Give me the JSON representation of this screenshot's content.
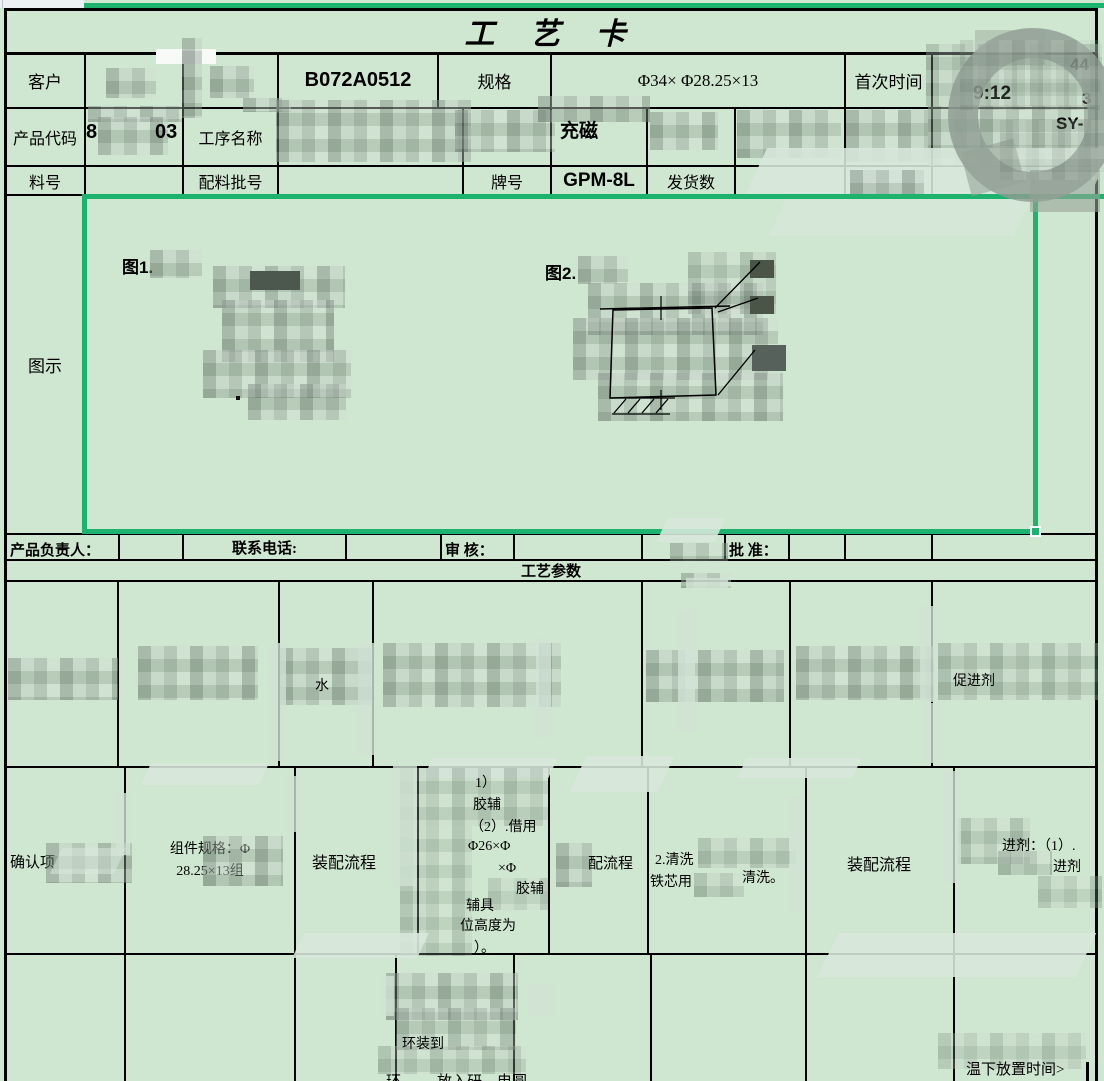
{
  "app": {
    "title_card": "工 艺 卡"
  },
  "header": {
    "customer_label": "客户",
    "order_code": "B072A0512",
    "spec_label": "规格",
    "spec_value": "Φ34× Φ28.25×13",
    "first_time_label": "首次时间",
    "first_time_fragments": {
      "a": "44",
      "b": "9:12",
      "c": "3"
    },
    "product_code_label": "产品代码",
    "product_code_fragments": {
      "left": "8",
      "right": "03"
    },
    "process_name_label": "工序名称",
    "process_fragment": "充磁",
    "right_fragment": "SY-",
    "material_label": "料号",
    "batch_label": "配料批号",
    "grade_label": "牌号",
    "grade_value": "GPM-8L",
    "ship_label": "发货数"
  },
  "diagram": {
    "row_label": "图示",
    "fig1_label": "图1.",
    "fig2_label": "图2."
  },
  "signatures": {
    "owner": "产品负责人：",
    "phone": "联系电话:",
    "review": "审  核：",
    "approve": "批  准："
  },
  "params": {
    "section_title": "工艺参数",
    "row_a": {
      "c3_fragment": "水",
      "c7_fragment": "促进剂"
    },
    "row_b": {
      "confirm_item": "确认项",
      "component_spec_line1": "组件规格：Φ",
      "component_spec_line2": "28.25×13组",
      "assembly_flow_1": "装配流程",
      "detail_lines": [
        "1）",
        "胶辅",
        "（2）.借用",
        "Φ26×Φ",
        "×Φ",
        "胶辅",
        "辅具",
        "位高度为",
        "）。"
      ],
      "flow_fragment": "配流程",
      "clean_line1": "2.清洗",
      "clean_line2": "铁芯用",
      "clean_line3": "清洗。",
      "assembly_flow_2": "装配流程",
      "promoter_line1": "进剂：（1）.",
      "promoter_line2": "进剂"
    },
    "row_c": {
      "frag_top": "环装到",
      "frag_bottom_1": "环",
      "frag_bottom_2": "放入研",
      "frag_bottom_3": "电圆",
      "time_note_fragment": "温下放置时间>"
    }
  }
}
